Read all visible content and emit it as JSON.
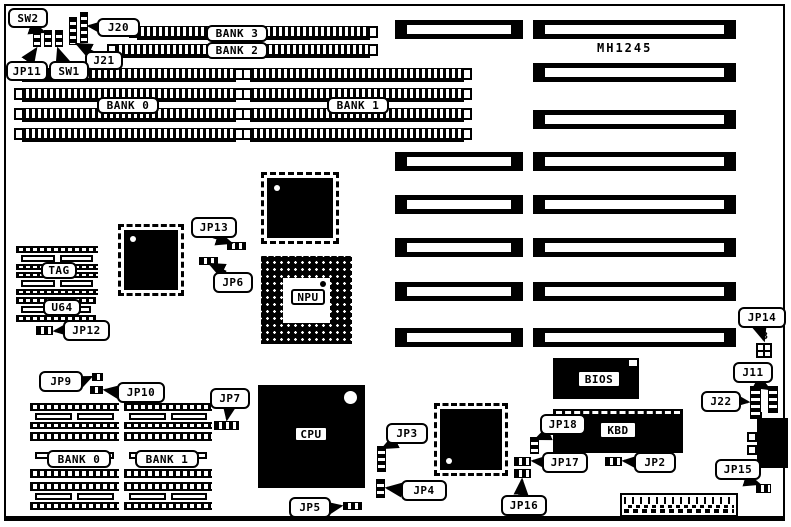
{
  "board": {
    "model": "MH1245"
  },
  "labels": {
    "sw2": "SW2",
    "jp11": "JP11",
    "sw1": "SW1",
    "j21": "J21",
    "j20": "J20",
    "bank3": "BANK 3",
    "bank2": "BANK 2",
    "bank0_top": "BANK 0",
    "bank1_top": "BANK 1",
    "tag": "TAG",
    "u64": "U64",
    "jp12": "JP12",
    "jp13": "JP13",
    "jp6": "JP6",
    "npu": "NPU",
    "cpu": "CPU",
    "bios": "BIOS",
    "kbd": "KBD",
    "jp9": "JP9",
    "jp10": "JP10",
    "jp7": "JP7",
    "bank0_bot": "BANK 0",
    "bank1_bot": "BANK 1",
    "jp3": "JP3",
    "jp4": "JP4",
    "jp5": "JP5",
    "jp18": "JP18",
    "jp17": "JP17",
    "jp16": "JP16",
    "jp2": "JP2",
    "jp14": "JP14",
    "jp14_pin": "3",
    "j11": "J11",
    "j22": "J22",
    "jp15": "JP15"
  },
  "colors": {
    "ink": "#000000",
    "paper": "#ffffff"
  }
}
